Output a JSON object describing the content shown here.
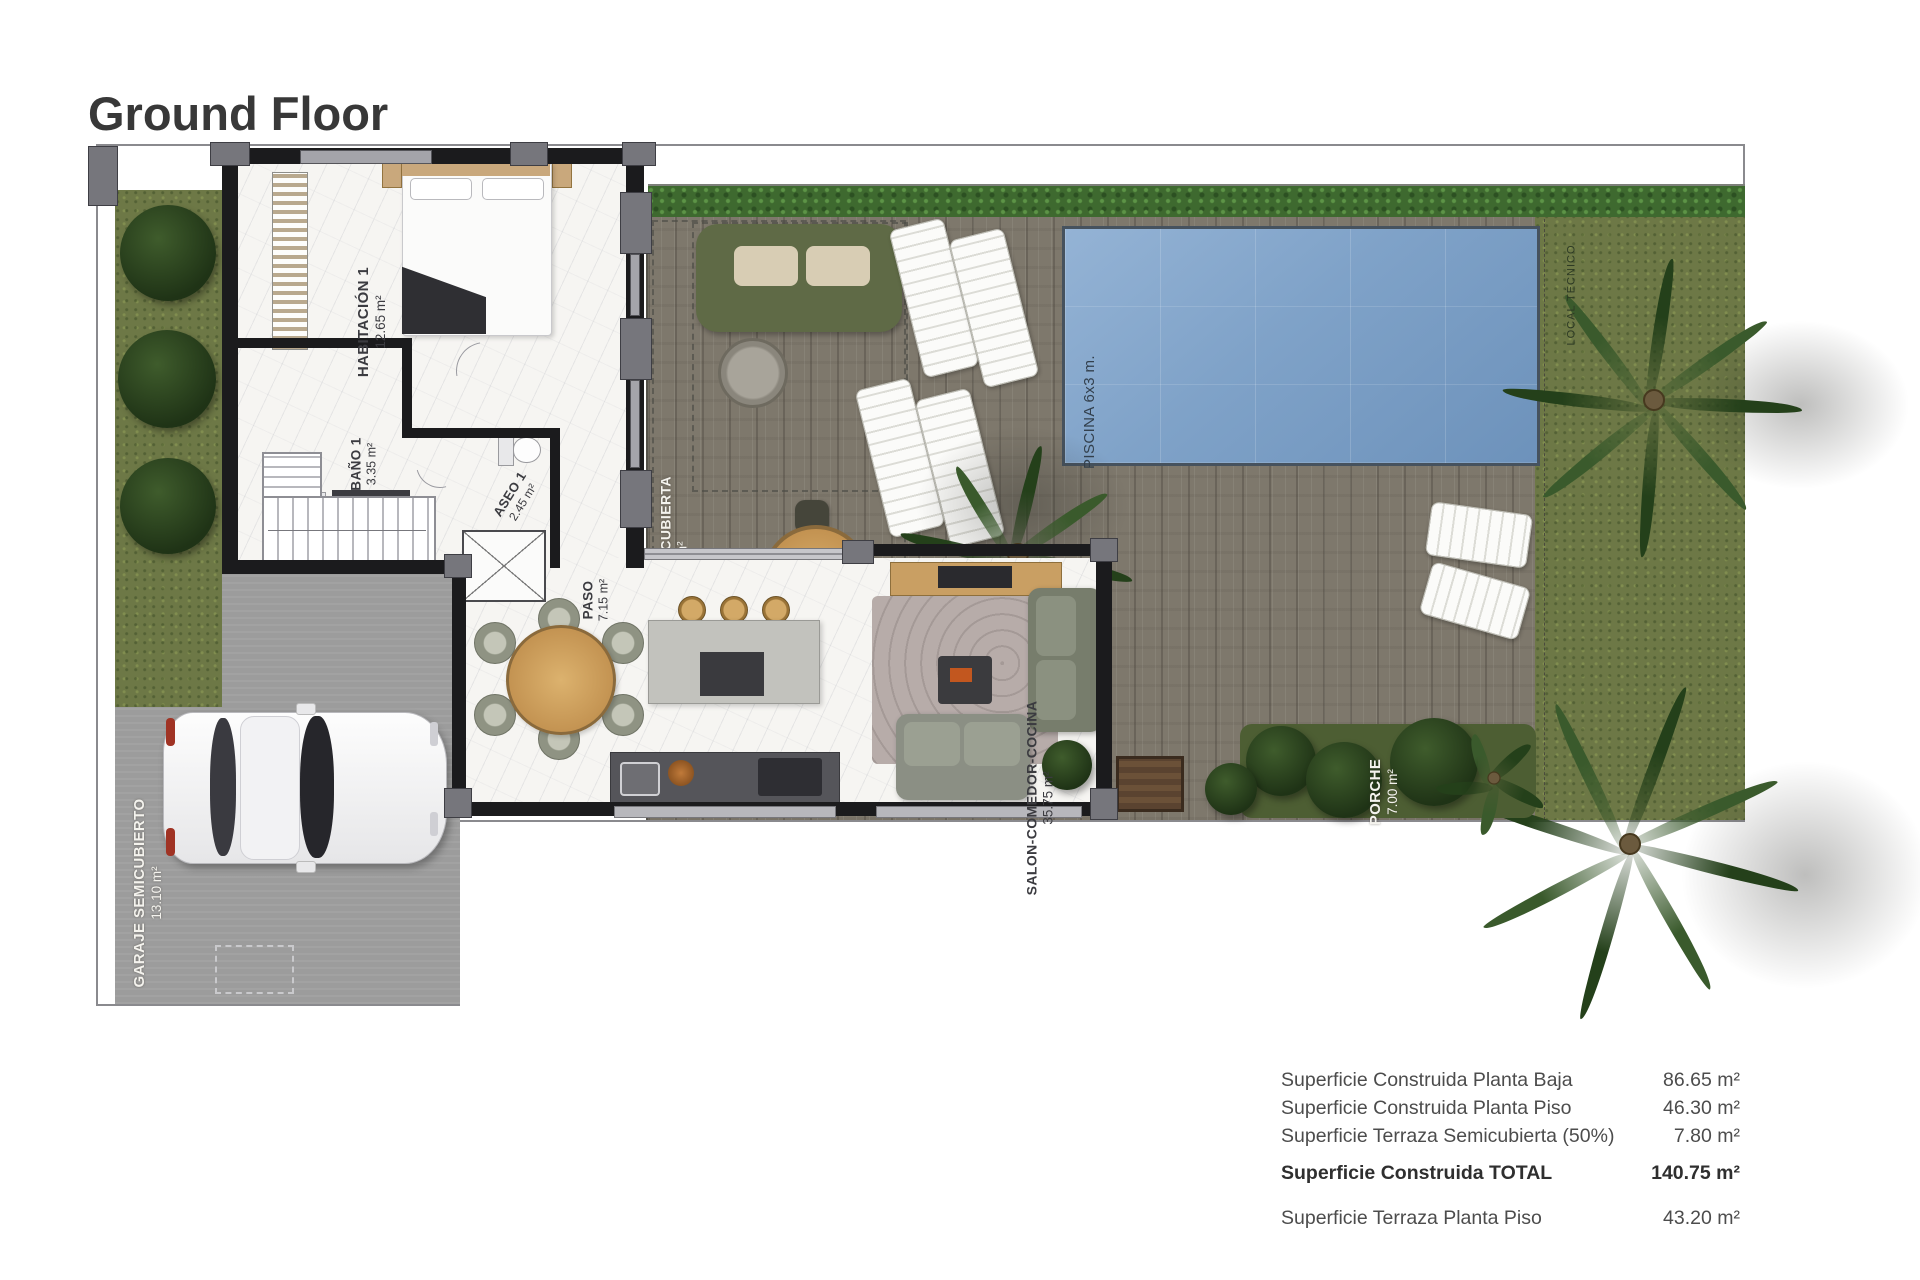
{
  "title": "Ground Floor",
  "rooms": {
    "habitacion1": {
      "name": "HABITACIÓN 1",
      "area": "12.65 m²"
    },
    "bano1": {
      "name": "BAÑO 1",
      "area": "3.35 m²"
    },
    "aseo1": {
      "name": "ASEO 1",
      "area": "2.45 m²"
    },
    "paso": {
      "name": "PASO",
      "area": "7.15 m²"
    },
    "terraza": {
      "name": "TERRAZA SEMICUBIERTA",
      "area": "18.25 m²"
    },
    "salon": {
      "name": "SALON-COMEDOR-COCINA",
      "area": "35.75 m²"
    },
    "garaje": {
      "name": "GARAJE SEMICUBIERTO",
      "area": "13.10 m²"
    },
    "porche": {
      "name": "PORCHE",
      "area": "7.00 m²"
    },
    "piscina": {
      "name": "PISCINA 6x3 m."
    },
    "local_tecnico": {
      "name": "LOCAL TÉCNICO"
    }
  },
  "summary": {
    "rows": [
      {
        "label": "Superficie Construida Planta Baja",
        "value": "86.65 m²"
      },
      {
        "label": "Superficie Construida Planta Piso",
        "value": "46.30 m²"
      },
      {
        "label": "Superficie Terraza Semicubierta (50%)",
        "value": "7.80 m²"
      }
    ],
    "total": {
      "label": "Superficie Construida TOTAL",
      "value": "140.75 m²"
    },
    "extra": {
      "label": "Superficie Terraza Planta Piso",
      "value": "43.20 m²"
    }
  },
  "colors": {
    "wall": "#1b1b1d",
    "deck": "#7e786c",
    "pool": "#7fa2c8",
    "grass": "#6d7846",
    "hedge": "#3e692f",
    "marble": "#f6f5f2",
    "concrete": "#9c9c9c"
  }
}
